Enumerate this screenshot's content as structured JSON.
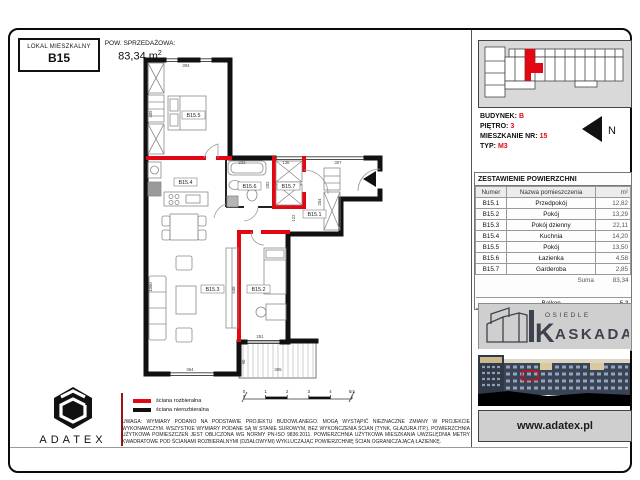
{
  "header": {
    "lokal_label": "LOKAL MIESZKALNY",
    "lokal_id": "B15",
    "area_label": "POW. SPRZEDAŻOWA:",
    "area_value": "83,34 m",
    "area_exp": "2"
  },
  "sidebar": {
    "info": [
      {
        "label": "BUDYNEK:",
        "value": "B"
      },
      {
        "label": "PIĘTRO:",
        "value": "3"
      },
      {
        "label": "MIESZKANIE NR:",
        "value": "15"
      },
      {
        "label": "TYP:",
        "value": "M3"
      }
    ],
    "compass": "N",
    "table": {
      "title": "ZESTAWIENIE POWIERZCHNI",
      "columns": [
        "Numer",
        "Nazwa pomieszczenia",
        "m²"
      ],
      "rows": [
        {
          "num": "B15.1",
          "name": "Przedpokój",
          "area": "12,82"
        },
        {
          "num": "B15.2",
          "name": "Pokój",
          "area": "13,29"
        },
        {
          "num": "B15.3",
          "name": "Pokój dzienny",
          "area": "22,11"
        },
        {
          "num": "B15.4",
          "name": "Kuchnia",
          "area": "14,20"
        },
        {
          "num": "B15.5",
          "name": "Pokój",
          "area": "13,50"
        },
        {
          "num": "B15.6",
          "name": "Łazienka",
          "area": "4,58"
        },
        {
          "num": "B15.7",
          "name": "Garderoba",
          "area": "2,85"
        }
      ],
      "total_label": "Suma",
      "total_value": "83,34",
      "balcony_label": "Balkon",
      "balcony_value": "5,3"
    },
    "brand": {
      "prefix": "OSIEDLE",
      "initial": "K",
      "rest": "ASKADA"
    },
    "website": "www.adatex.pl"
  },
  "plan": {
    "rooms": {
      "r1": "B15.1",
      "r2": "B15.2",
      "r3": "B15.3",
      "r4": "B15.4",
      "r5": "B15.5",
      "r6": "B15.6",
      "r7": "B15.7"
    },
    "dims": {
      "b155_w": "304",
      "b155_h": "409",
      "b156_w": "232",
      "b156_h": "202",
      "b157_w": "136",
      "hall_w": "307",
      "hall_h": "122",
      "closet_h": "204",
      "wall_h": "538",
      "left_h": "1060",
      "b153_w": "364",
      "b152_w": "251",
      "balcony_w": "365",
      "balcony_h": "90"
    }
  },
  "footer": {
    "logo": "ADATEX",
    "legend": [
      {
        "color": "#e30613",
        "label": "ściana rozbieralna"
      },
      {
        "color": "#111111",
        "label": "ściana nierozbieralna"
      }
    ],
    "scale": [
      "0",
      "1",
      "2",
      "3",
      "4",
      "5m"
    ],
    "disclaimer": "UWAGA: WYMIARY PODANO NA PODSTAWIE PROJEKTU BUDOWLANEGO. MOGĄ WYSTĄPIĆ NIEZNACZNE ZMIANY W PROJEKCIE WYKONAWCZYM. WSZYSTKIE WYMIARY PODANE SĄ W STANIE SUROWYM, BEZ WYKOŃCZENIA ŚCIAN (TYNK, GLAZURA ITP.). POWIERZCHNIA UŻYTKOWA POMIESZCZEŃ JEST OBLICZONA WG NORMY PN-ISO 9836:2011. POWIERZCHNIA UŻYTKOWA MIESZKANIA UWZGLĘDNIA METRY KWADRATOWE POD ŚCIANAMI ROZBIERALNYMI (DZIAŁOWYMI) WYKLUCZAJĄC POWIERZCHNIĘ ŚCIAN OGRANICZAJĄCĄ ŁAZIENKĘ."
  },
  "colors": {
    "accent": "#e30613",
    "panel_grey": "#d4d4d4",
    "navy": "#3a4456"
  }
}
